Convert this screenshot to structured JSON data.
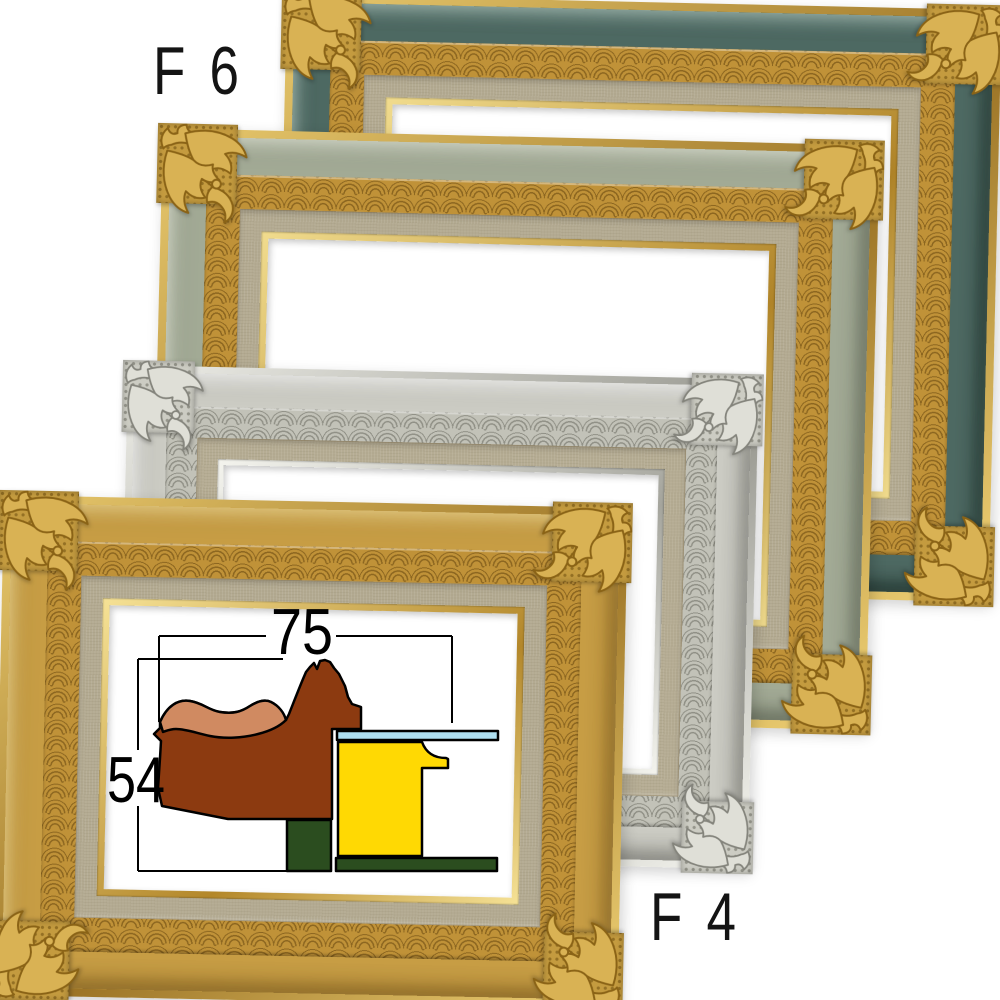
{
  "scene": {
    "background": "#ffffff",
    "description": "Four ornate picture frames overlapped diagonally with size labels and a moulding cross-section diagram"
  },
  "labels": {
    "top_frame": "F 6",
    "front_frame": "F 4"
  },
  "diagram": {
    "width_mm": "75",
    "height_mm": "54",
    "colors": {
      "moulding": "#8c3a10",
      "highlight": "#d08a61",
      "linerbar": "#ffd903",
      "glass": "#aedff0",
      "backing": "#2b4d1f",
      "outline": "#000000"
    }
  },
  "frames": [
    {
      "id": "frame-f6",
      "name": "gold-frame-dark-green-cove",
      "size_label": "F 6",
      "colors": {
        "lip1": "#e8c96e",
        "lip2": "#9c7426",
        "cove": "#4e6a63",
        "covehi": "rgba(205,228,218,0.55)",
        "covesh": "rgba(12,28,23,0.6)",
        "carved": "#c09238",
        "carveline": "rgba(88,58,8,0.5)",
        "liner": "#b3aa91",
        "inlip1": "#f1dc8e",
        "inlip2": "#b08428",
        "ornfill": "#d9b254",
        "ornstroke": "#8a6316",
        "ornbase": "#c49b3f",
        "orndot": "rgba(108,76,14,0.55)"
      }
    },
    {
      "id": "frame-f5",
      "name": "gold-frame-sage-cove",
      "colors": {
        "lip1": "#e8c96e",
        "lip2": "#9c7426",
        "cove": "#a3ab96",
        "covehi": "rgba(238,242,228,0.6)",
        "covesh": "rgba(58,66,50,0.5)",
        "carved": "#c09238",
        "carveline": "rgba(88,58,8,0.5)",
        "liner": "#b3aa91",
        "inlip1": "#f1dc8e",
        "inlip2": "#b08428",
        "ornfill": "#d9b254",
        "ornstroke": "#8a6316",
        "ornbase": "#c49b3f",
        "orndot": "rgba(108,76,14,0.55)"
      }
    },
    {
      "id": "frame-silver",
      "name": "silver-frame",
      "colors": {
        "lip1": "#eeeee8",
        "lip2": "#96968e",
        "cove": "#cdcdc5",
        "covehi": "rgba(255,255,255,0.65)",
        "covesh": "rgba(66,66,60,0.45)",
        "carved": "#c2c2b8",
        "carveline": "rgba(95,95,85,0.5)",
        "liner": "#b5ac93",
        "inlip1": "#f4f4ee",
        "inlip2": "#a5a59d",
        "ornfill": "#dfdfd7",
        "ornstroke": "#84847c",
        "ornbase": "#ccccc3",
        "orndot": "rgba(95,95,85,0.5)"
      }
    },
    {
      "id": "frame-f4",
      "name": "gold-frame-gold-cove",
      "size_label": "F 4",
      "colors": {
        "lip1": "#e8c96e",
        "lip2": "#9c7426",
        "cove": "#c89e45",
        "covehi": "rgba(255,236,172,0.55)",
        "covesh": "rgba(98,66,14,0.5)",
        "carved": "#c09238",
        "carveline": "rgba(88,58,8,0.5)",
        "liner": "#b3aa91",
        "inlip1": "#f6e296",
        "inlip2": "#b3872a",
        "ornfill": "#d9b254",
        "ornstroke": "#8a6316",
        "ornbase": "#c49b3f",
        "orndot": "rgba(108,76,14,0.55)"
      }
    }
  ]
}
